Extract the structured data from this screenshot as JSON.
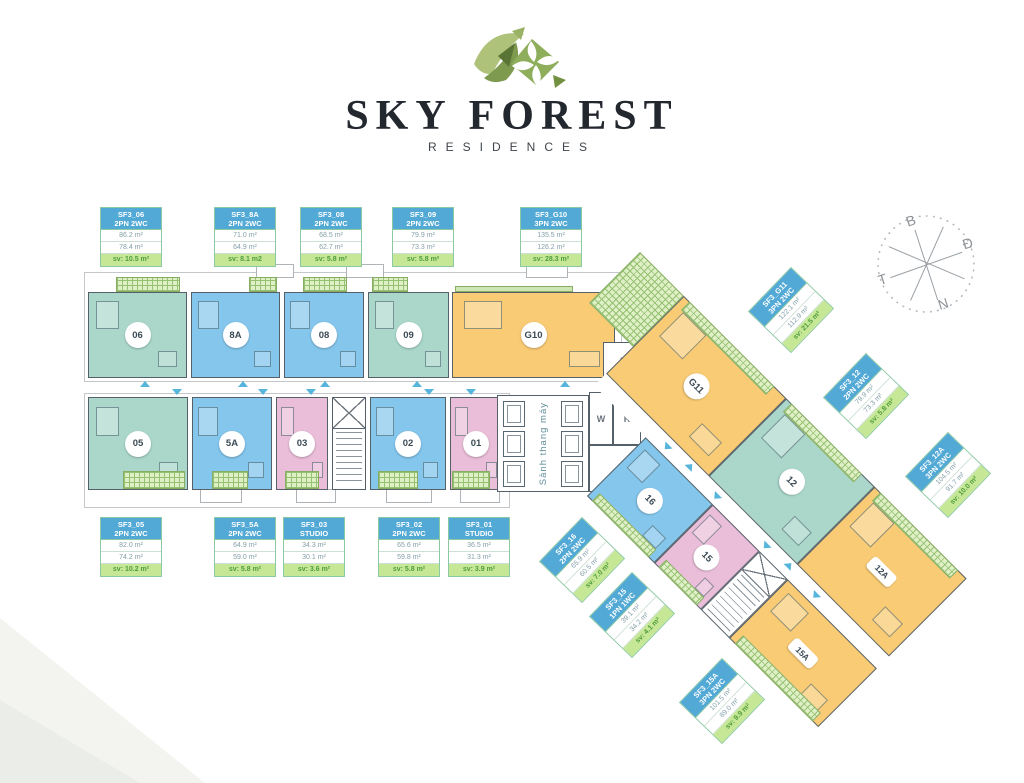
{
  "brand": {
    "title": "SKY FOREST",
    "subtitle": "RESIDENCES"
  },
  "compass": {
    "north": "B",
    "east": "Đ",
    "west": "T",
    "south": "N"
  },
  "core": {
    "lobby": "Sảnh thang máy",
    "w": "W",
    "r": "R",
    "e": "E"
  },
  "units": {
    "u06": "06",
    "u8a": "8A",
    "u08": "08",
    "u09": "09",
    "g10": "G10",
    "u05": "05",
    "u5a": "5A",
    "u03": "03",
    "u02": "02",
    "u01": "01",
    "g11": "G11",
    "u12": "12",
    "u12a": "12A",
    "u16": "16",
    "u15": "15",
    "u15a": "15A"
  },
  "info": {
    "top": [
      {
        "code": "SF3_06",
        "type": "2PN 2WC",
        "gross": "86.2 m²",
        "net": "78.4 m²",
        "sv": "sv: 10.5 m²"
      },
      {
        "code": "SF3_8A",
        "type": "2PN 2WC",
        "gross": "71.0 m²",
        "net": "64.9 m²",
        "sv": "sv: 8.1 m2"
      },
      {
        "code": "SF3_08",
        "type": "2PN 2WC",
        "gross": "68.5 m²",
        "net": "62.7 m²",
        "sv": "sv: 5.8 m²"
      },
      {
        "code": "SF3_09",
        "type": "2PN 2WC",
        "gross": "79.9 m²",
        "net": "73.3 m²",
        "sv": "sv: 5.8 m²"
      },
      {
        "code": "SF3_G10",
        "type": "3PN 2WC",
        "gross": "135.5 m²",
        "net": "126.2 m²",
        "sv": "sv: 28.3 m²"
      }
    ],
    "bottom": [
      {
        "code": "SF3_05",
        "type": "2PN 2WC",
        "gross": "82.0 m²",
        "net": "74.2 m²",
        "sv": "sv: 10.2 m²"
      },
      {
        "code": "SF3_5A",
        "type": "2PN 2WC",
        "gross": "64.9 m²",
        "net": "59.0 m²",
        "sv": "sv: 5.8 m²"
      },
      {
        "code": "SF3_03",
        "type": "STUDIO",
        "gross": "34.3 m²",
        "net": "30.1 m²",
        "sv": "sv: 3.6 m²"
      },
      {
        "code": "SF3_02",
        "type": "2PN 2WC",
        "gross": "65.6 m²",
        "net": "59.8 m²",
        "sv": "sv: 5.8 m²"
      },
      {
        "code": "SF3_01",
        "type": "STUDIO",
        "gross": "36.5 m²",
        "net": "31.3 m²",
        "sv": "sv: 3.9 m²"
      }
    ],
    "wing": [
      {
        "code": "SF3_G11",
        "type": "3PN 2WC",
        "gross": "122.1 m²",
        "net": "112.9 m²",
        "sv": "sv: 21.5 m²"
      },
      {
        "code": "SF3_12",
        "type": "2PN 2WC",
        "gross": "79.9 m²",
        "net": "73.3 m²",
        "sv": "sv: 5.8 m²"
      },
      {
        "code": "SF3_12A",
        "type": "3PN 2WC",
        "gross": "104.5 m²",
        "net": "91.7 m²",
        "sv": "sv: 10.0 m²"
      },
      {
        "code": "SF3_16",
        "type": "2PN 2WC",
        "gross": "65.9 m²",
        "net": "60.5 m²",
        "sv": "sv: 7.0 m²"
      },
      {
        "code": "SF3_15",
        "type": "1PN 1WC",
        "gross": "39.1 m²",
        "net": "34.2 m²",
        "sv": "sv: 4.1 m²"
      },
      {
        "code": "SF3_15A",
        "type": "3PN 2WC",
        "gross": "101.5 m²",
        "net": "89.0 m²",
        "sv": "sv: 9.9 m²"
      }
    ]
  },
  "colors": {
    "unit_teal": "#abd7cb",
    "unit_blue": "#84c6ec",
    "unit_pink": "#eabdd9",
    "unit_orange": "#f9cb74",
    "balcony_fill": "#dff0c6",
    "balcony_line": "#96c173",
    "info_header_blue": "#52a9d6",
    "sv_green_bg": "#c6e896",
    "sv_green_text": "#4f9c3c",
    "arrow_teal": "#55b5da",
    "wall_gray": "#566069",
    "brand_dark": "#23272e"
  }
}
